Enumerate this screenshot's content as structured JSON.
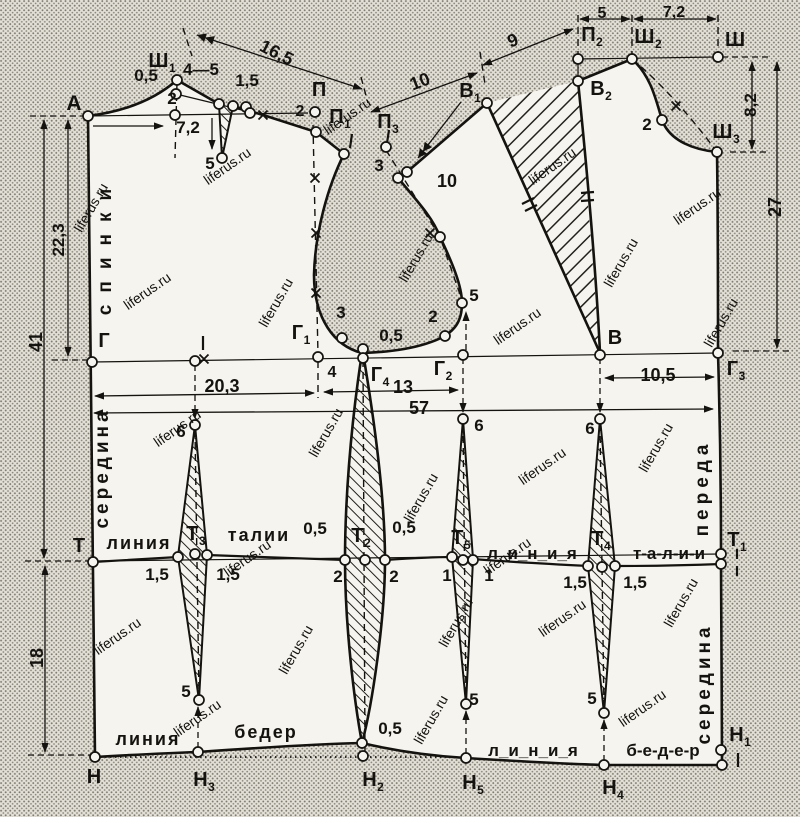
{
  "title": "Выкройка основы платья (чертёж спинки и переда)",
  "watermark_text": "liferus.ru",
  "colors": {
    "paper": "#f6f4ee",
    "halftone_bg": "#e3e0d8",
    "halftone_dot": "#7e7a6f",
    "ink": "#15130f",
    "watermark": "rgba(150,112,52,0.32)"
  },
  "labels": [
    {
      "n": "point-A",
      "t": "А",
      "x": 74,
      "y": 110,
      "s": 21
    },
    {
      "n": "point-Sh1",
      "t": "Ш",
      "sub": "1",
      "x": 162,
      "y": 67,
      "s": 20
    },
    {
      "n": "dim-0-5-neck",
      "t": "0,5",
      "x": 146,
      "y": 81,
      "s": 17
    },
    {
      "n": "dim-4-5",
      "t": "4—5",
      "x": 201,
      "y": 75,
      "s": 17
    },
    {
      "n": "dim-1-5-shoulder",
      "t": "1,5",
      "x": 247,
      "y": 86,
      "s": 17
    },
    {
      "n": "dim-2-neck",
      "t": "2",
      "x": 172,
      "y": 104,
      "s": 17
    },
    {
      "n": "dim-7-2-back",
      "t": "7,2",
      "x": 188,
      "y": 133,
      "s": 17
    },
    {
      "n": "dim-5-dart",
      "t": "5",
      "x": 210,
      "y": 169,
      "s": 17
    },
    {
      "n": "dim-16-5",
      "t": "16,5",
      "x": 274,
      "y": 58,
      "r": 27,
      "s": 18
    },
    {
      "n": "point-P",
      "t": "П",
      "x": 319,
      "y": 96,
      "s": 20
    },
    {
      "n": "dim-2-P",
      "t": "2",
      "x": 300,
      "y": 116,
      "s": 16
    },
    {
      "n": "point-P1",
      "t": "П",
      "sub": "1",
      "x": 340,
      "y": 123,
      "s": 20
    },
    {
      "n": "point-P3",
      "t": "П",
      "sub": "3",
      "x": 388,
      "y": 128,
      "s": 20
    },
    {
      "n": "dim-3-armhole",
      "t": "3",
      "x": 379,
      "y": 171,
      "s": 17
    },
    {
      "n": "dim-10-transfer",
      "t": "10",
      "x": 447,
      "y": 187,
      "s": 18
    },
    {
      "n": "dim-10-upper",
      "t": "10",
      "x": 422,
      "y": 87,
      "r": -21,
      "s": 18
    },
    {
      "n": "dim-9",
      "t": "9",
      "x": 515,
      "y": 46,
      "r": -22,
      "s": 18
    },
    {
      "n": "point-V1",
      "t": "В",
      "sub": "1",
      "x": 470,
      "y": 97,
      "s": 20
    },
    {
      "n": "point-P2",
      "t": "П",
      "sub": "2",
      "x": 592,
      "y": 41,
      "s": 20
    },
    {
      "n": "point-Sh2",
      "t": "Ш",
      "sub": "2",
      "x": 648,
      "y": 43,
      "s": 20
    },
    {
      "n": "point-Sh",
      "t": "Ш",
      "x": 735,
      "y": 46,
      "s": 20
    },
    {
      "n": "dim-5-top",
      "t": "5",
      "x": 602,
      "y": 18,
      "s": 16
    },
    {
      "n": "dim-7-2-top",
      "t": "7,2",
      "x": 674,
      "y": 17,
      "s": 16
    },
    {
      "n": "point-V2",
      "t": "В",
      "sub": "2",
      "x": 601,
      "y": 95,
      "s": 20
    },
    {
      "n": "dim-2-front-neck",
      "t": "2",
      "x": 647,
      "y": 130,
      "s": 17
    },
    {
      "n": "point-Sh3",
      "t": "Ш",
      "sub": "3",
      "x": 726,
      "y": 138,
      "s": 20
    },
    {
      "n": "dim-8-2",
      "t": "8,2",
      "x": 756,
      "y": 105,
      "r": -90,
      "s": 17
    },
    {
      "n": "dim-27",
      "t": "27",
      "x": 781,
      "y": 207,
      "r": -90,
      "s": 18
    },
    {
      "n": "dim-22-3",
      "t": "22,3",
      "x": 64,
      "y": 240,
      "r": -90,
      "s": 17
    },
    {
      "n": "dim-41",
      "t": "41",
      "x": 42,
      "y": 342,
      "r": -90,
      "s": 18
    },
    {
      "n": "dim-18",
      "t": "18",
      "x": 43,
      "y": 658,
      "r": -90,
      "s": 18
    },
    {
      "n": "text-spinki",
      "t": "спинки",
      "x": 111,
      "y": 246,
      "r": -90,
      "s": 19,
      "ls": 12
    },
    {
      "n": "text-seredina-left",
      "t": "середина",
      "x": 108,
      "y": 468,
      "r": -90,
      "s": 19,
      "ls": 4
    },
    {
      "n": "point-G",
      "t": "Г",
      "x": 104,
      "y": 347,
      "s": 20
    },
    {
      "n": "dim-20-3",
      "t": "20,3",
      "x": 222,
      "y": 392,
      "s": 18
    },
    {
      "n": "point-G1",
      "t": "Г",
      "sub": "1",
      "x": 301,
      "y": 339,
      "s": 20
    },
    {
      "n": "dim-4",
      "t": "4",
      "x": 332,
      "y": 377,
      "s": 16
    },
    {
      "n": "dim-0-5-armhole",
      "t": "0,5",
      "x": 391,
      "y": 341,
      "s": 17
    },
    {
      "n": "point-G4",
      "t": "Г",
      "sub": "4",
      "x": 380,
      "y": 381,
      "s": 20
    },
    {
      "n": "dim-13",
      "t": "13",
      "x": 403,
      "y": 393,
      "s": 18
    },
    {
      "n": "point-G2",
      "t": "Г",
      "sub": "2",
      "x": 443,
      "y": 375,
      "s": 20
    },
    {
      "n": "dim-57",
      "t": "57",
      "x": 419,
      "y": 414,
      "s": 18
    },
    {
      "n": "dim-5-armhole",
      "t": "5",
      "x": 474,
      "y": 301,
      "s": 17
    },
    {
      "n": "dim-2-armhole",
      "t": "2",
      "x": 433,
      "y": 322,
      "s": 17
    },
    {
      "n": "dim-3-armhole-low",
      "t": "3",
      "x": 341,
      "y": 318,
      "s": 17
    },
    {
      "n": "point-V",
      "t": "В",
      "x": 615,
      "y": 344,
      "s": 20
    },
    {
      "n": "dim-10-5",
      "t": "10,5",
      "x": 658,
      "y": 381,
      "s": 18
    },
    {
      "n": "point-G3",
      "t": "Г",
      "sub": "3",
      "x": 736,
      "y": 375,
      "s": 20
    },
    {
      "n": "dim-6-back",
      "t": "6",
      "x": 181,
      "y": 437,
      "s": 17
    },
    {
      "n": "dim-6-front1",
      "t": "6",
      "x": 479,
      "y": 431,
      "s": 17
    },
    {
      "n": "dim-6-front2",
      "t": "6",
      "x": 590,
      "y": 434,
      "s": 17
    },
    {
      "n": "point-T",
      "t": "Т",
      "x": 79,
      "y": 552,
      "s": 20
    },
    {
      "n": "text-liniya-waist-left",
      "t": "линия",
      "x": 139,
      "y": 549,
      "s": 18,
      "ls": 2
    },
    {
      "n": "point-T3",
      "t": "Т",
      "sub": "3",
      "x": 196,
      "y": 540,
      "s": 20
    },
    {
      "n": "text-talii-left",
      "t": "талии",
      "x": 259,
      "y": 541,
      "s": 18,
      "ls": 2
    },
    {
      "n": "dim-0-5-waist1",
      "t": "0,5",
      "x": 315,
      "y": 534,
      "s": 17
    },
    {
      "n": "point-T2",
      "t": "Т",
      "sub": "2",
      "x": 361,
      "y": 542,
      "s": 20
    },
    {
      "n": "dim-0-5-waist2",
      "t": "0,5",
      "x": 404,
      "y": 533,
      "s": 17
    },
    {
      "n": "dim-1-5-w1",
      "t": "1,5",
      "x": 157,
      "y": 580,
      "s": 17
    },
    {
      "n": "dim-1-5-w2",
      "t": "1,5",
      "x": 228,
      "y": 580,
      "s": 17
    },
    {
      "n": "dim-2-w1",
      "t": "2",
      "x": 338,
      "y": 582,
      "s": 17
    },
    {
      "n": "dim-2-w2",
      "t": "2",
      "x": 394,
      "y": 582,
      "s": 17
    },
    {
      "n": "point-T5",
      "t": "Т",
      "sub": "5",
      "x": 461,
      "y": 544,
      "s": 20
    },
    {
      "n": "dim-1-w1",
      "t": "1",
      "x": 447,
      "y": 581,
      "s": 17
    },
    {
      "n": "dim-1-w2",
      "t": "1",
      "x": 489,
      "y": 581,
      "s": 17
    },
    {
      "n": "text-liniya-waist-right",
      "t": "л_и_н_и_я",
      "x": 532,
      "y": 559,
      "s": 17
    },
    {
      "n": "point-T4",
      "t": "Т",
      "sub": "4",
      "x": 601,
      "y": 545,
      "s": 20
    },
    {
      "n": "text-talii-right",
      "t": "т-а-л-и-и",
      "x": 669,
      "y": 559,
      "s": 17
    },
    {
      "n": "point-T1",
      "t": "Т",
      "sub": "1",
      "x": 737,
      "y": 546,
      "s": 20
    },
    {
      "n": "dim-1-5-w3",
      "t": "1,5",
      "x": 575,
      "y": 588,
      "s": 17
    },
    {
      "n": "dim-1-5-w4",
      "t": "1,5",
      "x": 635,
      "y": 588,
      "s": 17
    },
    {
      "n": "text-pereda",
      "t": "переда",
      "x": 708,
      "y": 488,
      "r": -90,
      "s": 19,
      "ls": 5
    },
    {
      "n": "text-seredina-right",
      "t": "середина",
      "x": 710,
      "y": 684,
      "r": -90,
      "s": 19,
      "ls": 4
    },
    {
      "n": "text-liniya-hip-left",
      "t": "линия",
      "x": 148,
      "y": 745,
      "s": 18,
      "ls": 2
    },
    {
      "n": "text-beder-left",
      "t": "бедер",
      "x": 266,
      "y": 738,
      "s": 18,
      "ls": 2
    },
    {
      "n": "dim-5-hip1",
      "t": "5",
      "x": 186,
      "y": 697,
      "s": 17
    },
    {
      "n": "dim-0-5-hip",
      "t": "0,5",
      "x": 390,
      "y": 734,
      "s": 17
    },
    {
      "n": "dim-5-hip2",
      "t": "5",
      "x": 474,
      "y": 705,
      "s": 17
    },
    {
      "n": "dim-5-hip3",
      "t": "5",
      "x": 592,
      "y": 704,
      "s": 17
    },
    {
      "n": "text-liniya-hip-right",
      "t": "л_и_н_и_я",
      "x": 533,
      "y": 756,
      "s": 17
    },
    {
      "n": "text-beder-right",
      "t": "б-е-д-е-р",
      "x": 663,
      "y": 756,
      "s": 17
    },
    {
      "n": "point-N",
      "t": "Н",
      "x": 94,
      "y": 783,
      "s": 20
    },
    {
      "n": "point-N3",
      "t": "Н",
      "sub": "3",
      "x": 204,
      "y": 786,
      "s": 20
    },
    {
      "n": "point-N2",
      "t": "Н",
      "sub": "2",
      "x": 373,
      "y": 786,
      "s": 20
    },
    {
      "n": "point-N5",
      "t": "Н",
      "sub": "5",
      "x": 473,
      "y": 789,
      "s": 20
    },
    {
      "n": "point-N4",
      "t": "Н",
      "sub": "4",
      "x": 613,
      "y": 794,
      "s": 20
    },
    {
      "n": "point-N1",
      "t": "Н",
      "sub": "1",
      "x": 740,
      "y": 741,
      "s": 20
    }
  ],
  "watermarks": [
    {
      "x": 230,
      "y": 170,
      "r": -35
    },
    {
      "x": 350,
      "y": 120,
      "r": -35
    },
    {
      "x": 95,
      "y": 210,
      "r": -60
    },
    {
      "x": 150,
      "y": 295,
      "r": -35
    },
    {
      "x": 280,
      "y": 305,
      "r": -60
    },
    {
      "x": 420,
      "y": 260,
      "r": -60
    },
    {
      "x": 555,
      "y": 170,
      "r": -35
    },
    {
      "x": 625,
      "y": 265,
      "r": -60
    },
    {
      "x": 700,
      "y": 210,
      "r": -35
    },
    {
      "x": 180,
      "y": 432,
      "r": -35
    },
    {
      "x": 330,
      "y": 435,
      "r": -60
    },
    {
      "x": 520,
      "y": 330,
      "r": -35
    },
    {
      "x": 660,
      "y": 450,
      "r": -60
    },
    {
      "x": 250,
      "y": 562,
      "r": -35
    },
    {
      "x": 425,
      "y": 500,
      "r": -60
    },
    {
      "x": 545,
      "y": 470,
      "r": -35
    },
    {
      "x": 120,
      "y": 640,
      "r": -35
    },
    {
      "x": 300,
      "y": 652,
      "r": -60
    },
    {
      "x": 460,
      "y": 625,
      "r": -60
    },
    {
      "x": 565,
      "y": 622,
      "r": -35
    },
    {
      "x": 685,
      "y": 605,
      "r": -60
    },
    {
      "x": 200,
      "y": 722,
      "r": -35
    },
    {
      "x": 435,
      "y": 722,
      "r": -60
    },
    {
      "x": 645,
      "y": 712,
      "r": -35
    },
    {
      "x": 725,
      "y": 325,
      "r": -60
    },
    {
      "x": 510,
      "y": 560,
      "r": -35
    }
  ]
}
